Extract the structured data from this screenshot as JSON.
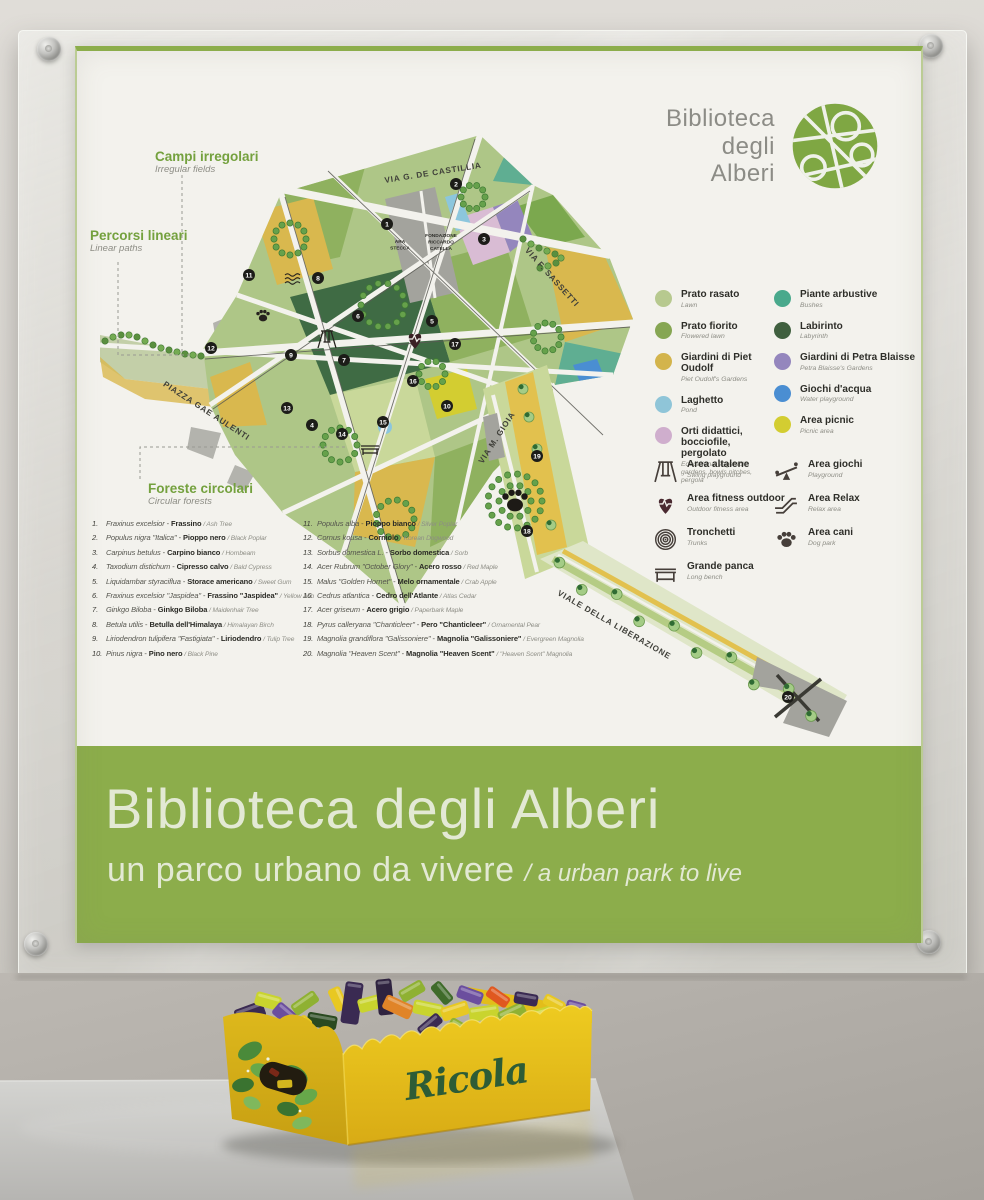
{
  "sign": {
    "logo": {
      "line1": "Biblioteca",
      "line2": "degli",
      "line3": "Alberi"
    },
    "map_labels": {
      "campi": {
        "title": "Campi irregolari",
        "sub": "Irregular fields"
      },
      "percorsi": {
        "title": "Percorsi lineari",
        "sub": "Linear paths"
      },
      "foreste": {
        "title": "Foreste circolari",
        "sub": "Circular forests"
      }
    },
    "streets": {
      "castillia": "VIA G. DE CASTILLIA",
      "sassetti": "VIA F. SASSETTI",
      "aulenti": "PIAZZA GAE AULENTI",
      "gioia": "VIA M. GIOIA",
      "liberazione": "VIALE DELLA LIBERAZIONE"
    },
    "buildings": {
      "stecca1": "ARA",
      "stecca2": "STECCA",
      "fond1": "FONDAZIONE",
      "fond2": "RICCARDO",
      "fond3": "CATELLA"
    },
    "trees": [
      {
        "n": "1.",
        "latin": "Fraxinus excelsior",
        "it": "Frassino",
        "en": "Ash Tree"
      },
      {
        "n": "2.",
        "latin": "Populus nigra \"Italica\"",
        "it": "Pioppo nero",
        "en": "Black Poplar"
      },
      {
        "n": "3.",
        "latin": "Carpinus betulus",
        "it": "Carpino bianco",
        "en": "Hornbeam"
      },
      {
        "n": "4.",
        "latin": "Taxodium distichum",
        "it": "Cipresso calvo",
        "en": "Bald Cypress"
      },
      {
        "n": "5.",
        "latin": "Liquidambar styraciflua",
        "it": "Storace americano",
        "en": "Sweet Gum"
      },
      {
        "n": "6.",
        "latin": "Fraxinus excelsior \"Jaspidea\"",
        "it": "Frassino \"Jaspidea\"",
        "en": "Yellow Ash"
      },
      {
        "n": "7.",
        "latin": "Ginkgo Biloba",
        "it": "Ginkgo Biloba",
        "en": "Maidenhair Tree"
      },
      {
        "n": "8.",
        "latin": "Betula utilis",
        "it": "Betulla dell'Himalaya",
        "en": "Himalayan Birch"
      },
      {
        "n": "9.",
        "latin": "Liriodendron tulipifera \"Fastigiata\"",
        "it": "Liriodendro",
        "en": "Tulip Tree"
      },
      {
        "n": "10.",
        "latin": "Pinus nigra",
        "it": "Pino nero",
        "en": "Black Pine"
      },
      {
        "n": "11.",
        "latin": "Populus alba",
        "it": "Pioppo bianco",
        "en": "Silver Poplar"
      },
      {
        "n": "12.",
        "latin": "Cornus kousa",
        "it": "Corniolo",
        "en": "Korean Dogwood"
      },
      {
        "n": "13.",
        "latin": "Sorbus domestica L.",
        "it": "Sorbo domestica",
        "en": "Sorb"
      },
      {
        "n": "14.",
        "latin": "Acer Rubrum \"October Glory\"",
        "it": "Acero rosso",
        "en": "Red Maple"
      },
      {
        "n": "15.",
        "latin": "Malus \"Golden Hornet\"",
        "it": "Melo ornamentale",
        "en": "Crab Apple"
      },
      {
        "n": "16.",
        "latin": "Cedrus atlantica",
        "it": "Cedro dell'Atlante",
        "en": "Atlas Cedar"
      },
      {
        "n": "17.",
        "latin": "Acer griseum",
        "it": "Acero grigio",
        "en": "Paperbark Maple"
      },
      {
        "n": "18.",
        "latin": "Pyrus calleryana \"Chanticleer\"",
        "it": "Pero \"Chanticleer\"",
        "en": "Ornamental Pear"
      },
      {
        "n": "19.",
        "latin": "Magnolia grandiflora \"Galissoniere\"",
        "it": "Magnolia \"Galissoniere\"",
        "en": "Evergreen Magnolia"
      },
      {
        "n": "20.",
        "latin": "Magnolia \"Heaven Scent\"",
        "it": "Magnolia \"Heaven Scent\"",
        "en": "\"Heaven Scent\" Magnolia"
      }
    ],
    "marker_numbers": [
      "1",
      "2",
      "3",
      "4",
      "5",
      "6",
      "7",
      "8",
      "9",
      "10",
      "11",
      "12",
      "13",
      "14",
      "15",
      "16",
      "17",
      "18",
      "19",
      "20"
    ],
    "legend_left": [
      {
        "name": "Prato rasato",
        "sub": "Lawn",
        "color": "#b7c98f"
      },
      {
        "name": "Prato fiorito",
        "sub": "Flowered lawn",
        "color": "#86a653"
      },
      {
        "name": "Giardini di Piet Oudolf",
        "sub": "Piet Oudolf's Gardens",
        "color": "#d3b44c"
      },
      {
        "name": "Laghetto",
        "sub": "Pond",
        "color": "#8fc5d8"
      },
      {
        "name": "Orti didattici, bocciofile, pergolato",
        "sub": "Educational vegetable gardens, bowls pitches, pergola",
        "color": "#cfaecd"
      }
    ],
    "legend_right": [
      {
        "name": "Piante arbustive",
        "sub": "Bushes",
        "color": "#49a98c"
      },
      {
        "name": "Labirinto",
        "sub": "Labyrinth",
        "color": "#40603f"
      },
      {
        "name": "Giardini di Petra Blaisse",
        "sub": "Petra Blaisse's Gardens",
        "color": "#9486bd"
      },
      {
        "name": "Giochi d'acqua",
        "sub": "Water playground",
        "color": "#4a8ed2"
      },
      {
        "name": "Area picnic",
        "sub": "Picnic area",
        "color": "#d3cd31"
      }
    ],
    "icons_left": [
      {
        "name": "Area altalene",
        "sub": "Swing playground"
      },
      {
        "name": "Area fitness outdoor",
        "sub": "Outdoor fitness area"
      },
      {
        "name": "Tronchetti",
        "sub": "Trunks"
      },
      {
        "name": "Grande panca",
        "sub": "Long bench"
      }
    ],
    "icons_right": [
      {
        "name": "Area giochi",
        "sub": "Playground"
      },
      {
        "name": "Area Relax",
        "sub": "Relax area"
      },
      {
        "name": "Area cani",
        "sub": "Dog park"
      }
    ],
    "banner": {
      "title": "Biblioteca degli Alberi",
      "subtitle_it": "un parco urbano da vivere",
      "subtitle_en": "/ a urban park to live"
    },
    "colors": {
      "banner_green": "#8cad4b",
      "logo_green": "#7fa743",
      "label_green": "#74a13e"
    }
  },
  "candy_box": {
    "brand": "Ricola"
  }
}
